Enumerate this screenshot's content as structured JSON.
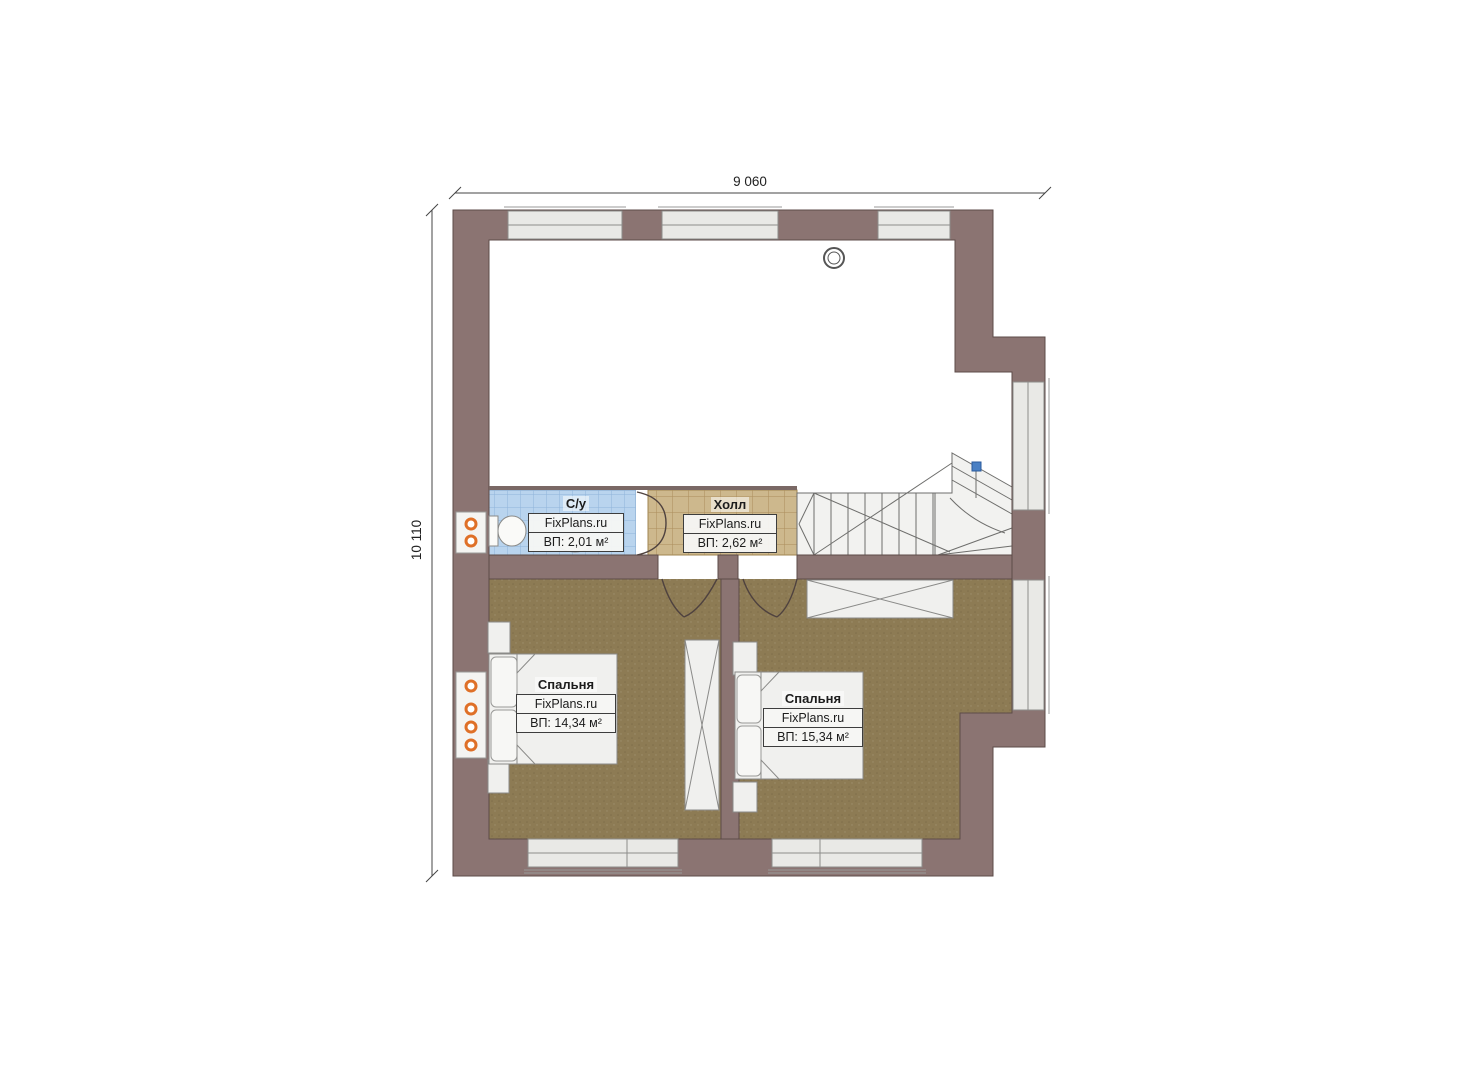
{
  "plan": {
    "watermark": "FixPlans.ru",
    "dimensions": {
      "top": "9 060",
      "left": "10 110"
    },
    "rooms": {
      "bathroom": {
        "title": "С/у",
        "watermark": "FixPlans.ru",
        "area": "ВП: 2,01 м²"
      },
      "hall": {
        "title": "Холл",
        "watermark": "FixPlans.ru",
        "area": "ВП: 2,62 м²"
      },
      "bedroom_left": {
        "title": "Спальня",
        "watermark": "FixPlans.ru",
        "area": "ВП: 14,34 м²"
      },
      "bedroom_right": {
        "title": "Спальня",
        "watermark": "FixPlans.ru",
        "area": "ВП: 15,34 м²"
      }
    },
    "colors": {
      "wall": "#8b7472",
      "wall_outline": "#5d4b48",
      "floor_bedroom": "#8d7b54",
      "floor_hall": "#cdb88d",
      "floor_bathroom": "#b9d4ee",
      "window": "#e9e9e6",
      "stairs": "#f2f2f0",
      "radiator_accent": "#df7028",
      "stair_marker": "#4a80c4"
    }
  }
}
